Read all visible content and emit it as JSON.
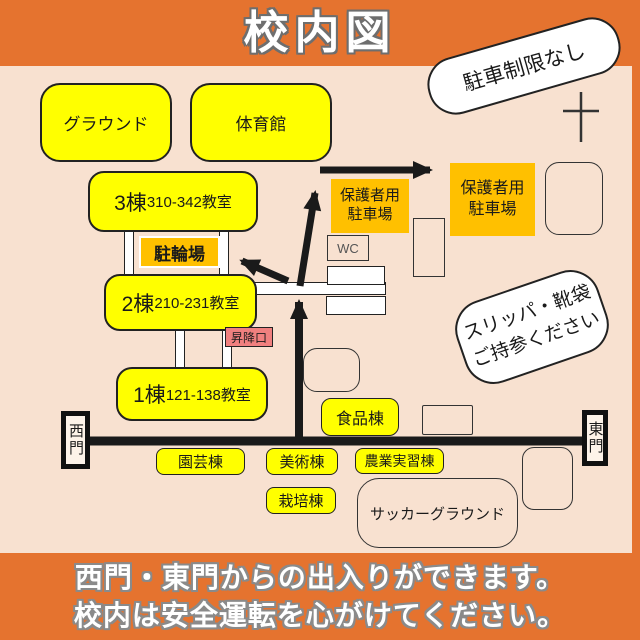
{
  "title": "校内図",
  "notes": {
    "parking_note": "駐車制限なし",
    "slippers_note": "スリッパ・靴袋\nご持参ください"
  },
  "banner": {
    "line1": "西門・東門からの出入りができます。",
    "line2": "校内は安全運転を心がけてください。"
  },
  "gates": {
    "west": "西門",
    "east": "東門"
  },
  "buildings": {
    "ground": "グラウンド",
    "gym": "体育館",
    "bldg3_name": "3棟",
    "bldg3_rooms": "310-342教室",
    "bldg2_name": "2棟",
    "bldg2_rooms": "210-231教室",
    "bldg1_name": "1棟",
    "bldg1_rooms": "121-138教室",
    "bike_parking": "駐輪場",
    "parents_parking_1": "保護者用\n駐車場",
    "parents_parking_2": "保護者用\n駐車場",
    "entrance": "昇降口",
    "wc": "WC",
    "food": "食品棟",
    "gardening": "園芸棟",
    "art": "美術棟",
    "agriculture": "農業実習棟",
    "cultivation": "栽培棟",
    "soccer": "サッカーグラウンド"
  },
  "colors": {
    "band_orange": "#E5732F",
    "background_peach": "#F8E1D0",
    "building_yellow": "#FFFF00",
    "parking_orange": "#FFC000",
    "entrance_pink": "#F0807F",
    "road_black": "#1A1A1A"
  }
}
